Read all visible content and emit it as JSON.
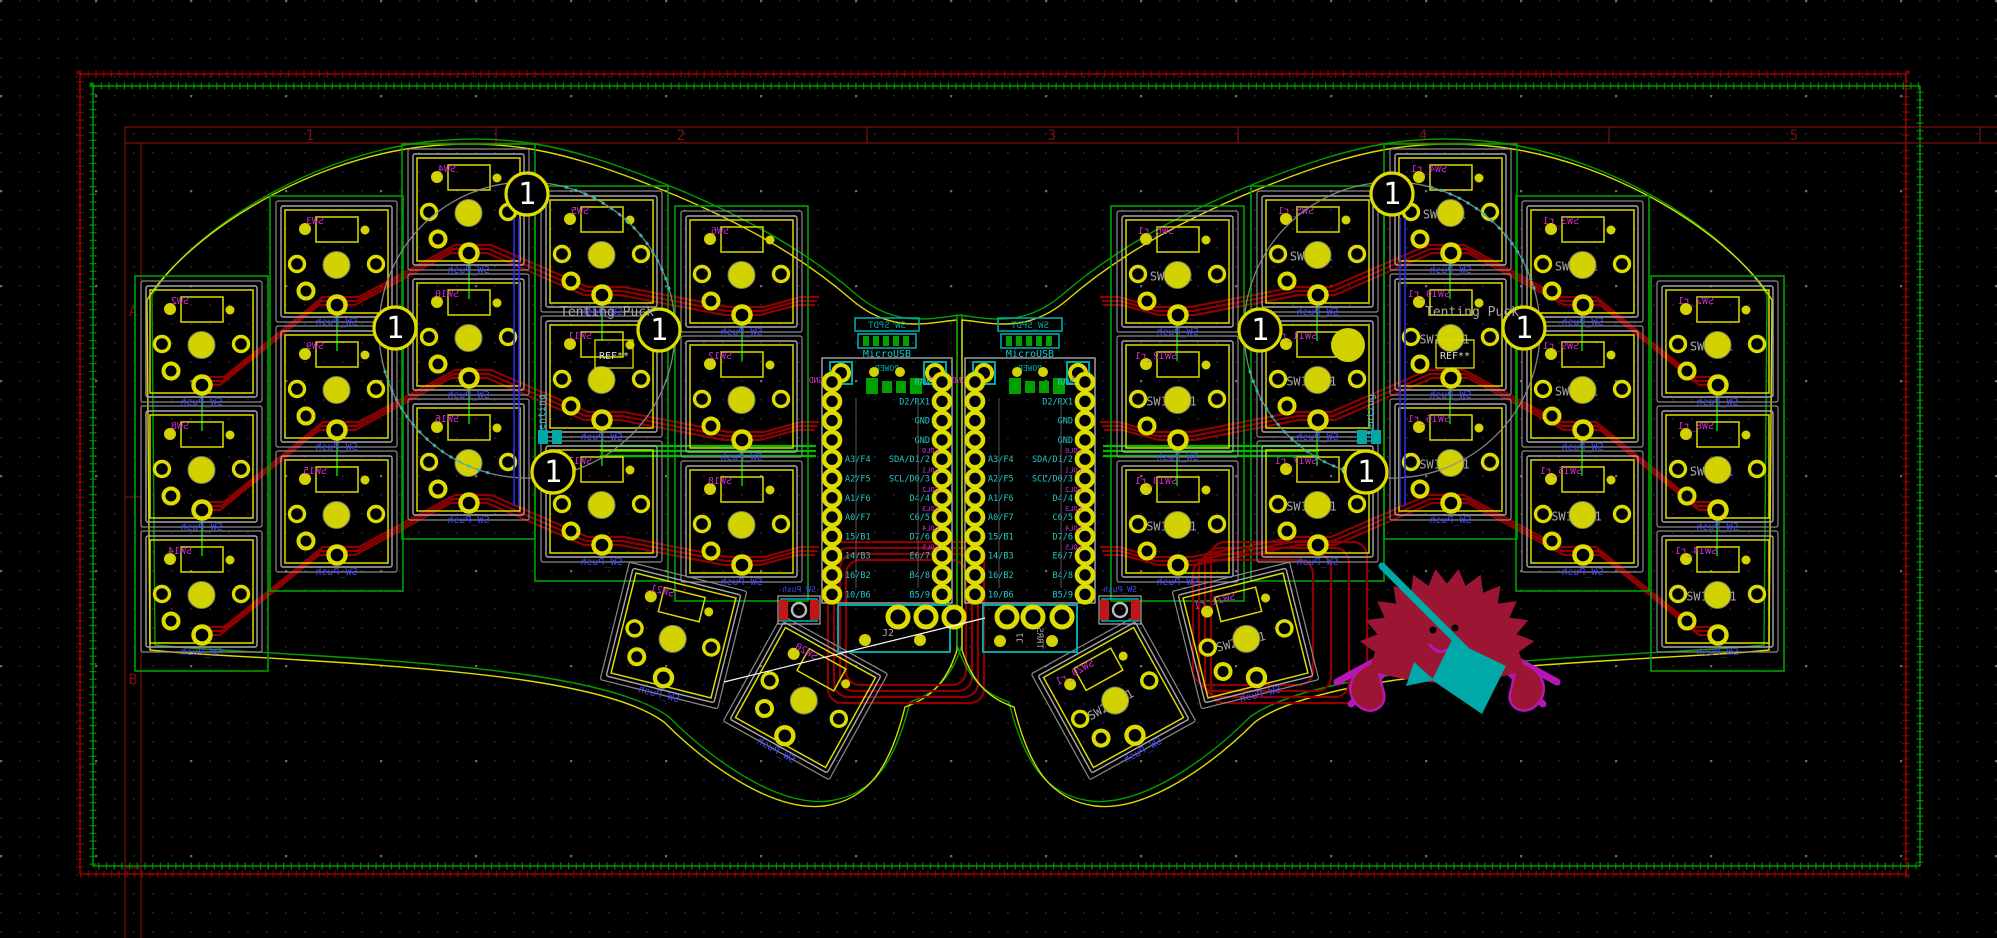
{
  "page_frame": {
    "zone_numbers": [
      "1",
      "2",
      "3",
      "4",
      "5"
    ],
    "row_letters": [
      "A",
      "B"
    ]
  },
  "texts": {
    "tenting_puck": "Tenting Puck",
    "tenting_ref": "REF**",
    "tenting_vertical": "tenting",
    "key_value": "SW_Push",
    "usb": "MicroUSB",
    "power": "POWER",
    "power_switch": "SW_SPDT",
    "battery": "Bat+",
    "gnd": "GND",
    "j2": "J2",
    "j1": "J1",
    "trrs": "TRRS",
    "reset_value": "SW_Push",
    "puck_hole": "1"
  },
  "mcu": {
    "pins_inner": [
      "",
      "",
      "",
      "",
      "A3/F4",
      "A2/F5",
      "A1/F6",
      "A0/F7",
      "15/B1",
      "14/B3",
      "16/B2",
      "10/B6"
    ],
    "pins_outer": [
      "RAW",
      "D2/RX1",
      "GND",
      "GND",
      "SDA/D1/2",
      "SCL/D0/3",
      "D4/4",
      "C6/5",
      "D7/6",
      "E6/7",
      "B4/8",
      "B5/9"
    ],
    "net_labels": [
      "COL0",
      "COL1",
      "COL2",
      "COL3",
      "COL4",
      "COL5"
    ]
  },
  "keys": {
    "left_columns": [
      [
        "SW2",
        "SW8",
        "SW14"
      ],
      [
        "SW3",
        "SW9",
        "SW15"
      ],
      [
        "SW4",
        "SW10",
        "SW16"
      ],
      [
        "SW5",
        "SW11",
        "SW17"
      ],
      [
        "SW6",
        "SW12",
        "SW18"
      ]
    ],
    "left_thumbs": [
      "SW21",
      "SW20"
    ],
    "right_suffix": "_r1"
  },
  "colors": {
    "bg": "#000000",
    "grid_fine": "#2e2e2e",
    "grid_coarse": "#6a6a6a",
    "yellow": "#dcdc00",
    "yellow_fill": "#d2d200",
    "grey": "#a8a8a8",
    "grey_dim": "#8a8a8a",
    "green": "#00a000",
    "green_bright": "#00bc00",
    "red_trace": "#8f0000",
    "red_pad": "#c01818",
    "magenta": "#cc2fcc",
    "cyan": "#1fc8c8",
    "teal": "#00a8a8",
    "blue": "#4646ff",
    "blue_dark": "#2a2af0",
    "white": "#ffffff",
    "frame": "#7d1111",
    "crab_body": "#9c1532",
    "crab_outline": "#b517b5",
    "crab_broom": "#00a8a8"
  },
  "geometry": {
    "axis": 1919,
    "key": {
      "size": 103,
      "pitch": 125
    },
    "columns": [
      {
        "x": 150,
        "y": 290
      },
      {
        "x": 285,
        "y": 210
      },
      {
        "x": 417,
        "y": 158
      },
      {
        "x": 550,
        "y": 200
      },
      {
        "x": 690,
        "y": 220
      }
    ],
    "thumbs": [
      {
        "x": 622,
        "y": 584,
        "rot": 14
      },
      {
        "x": 754,
        "y": 646,
        "rot": 29
      }
    ],
    "mcu": {
      "left_x": 822,
      "right_x": 965,
      "y": 358,
      "w": 130,
      "h": 245,
      "pad_y0": 382,
      "pad_step": 19.3
    },
    "puck": {
      "cx": 527,
      "cy": 330,
      "r": 148,
      "holes": [
        [
          527,
          194
        ],
        [
          395,
          328
        ],
        [
          659,
          330
        ],
        [
          553,
          472
        ]
      ]
    },
    "zone_red": [
      80,
      74,
      1826,
      800
    ],
    "zone_green": [
      93,
      86,
      1827,
      780
    ],
    "frame": {
      "top_y1": 127,
      "top_y2": 143,
      "left_x1": 125,
      "left_x2": 141,
      "dividers_x": [
        496,
        867,
        1238,
        1609,
        1980
      ],
      "numbers_x": [
        310,
        681,
        1052,
        1423,
        1794
      ],
      "dividers_y": [
        497,
        868
      ],
      "letters_y": [
        316,
        684
      ]
    },
    "grid": {
      "fine": 19,
      "coarse": 95
    }
  }
}
